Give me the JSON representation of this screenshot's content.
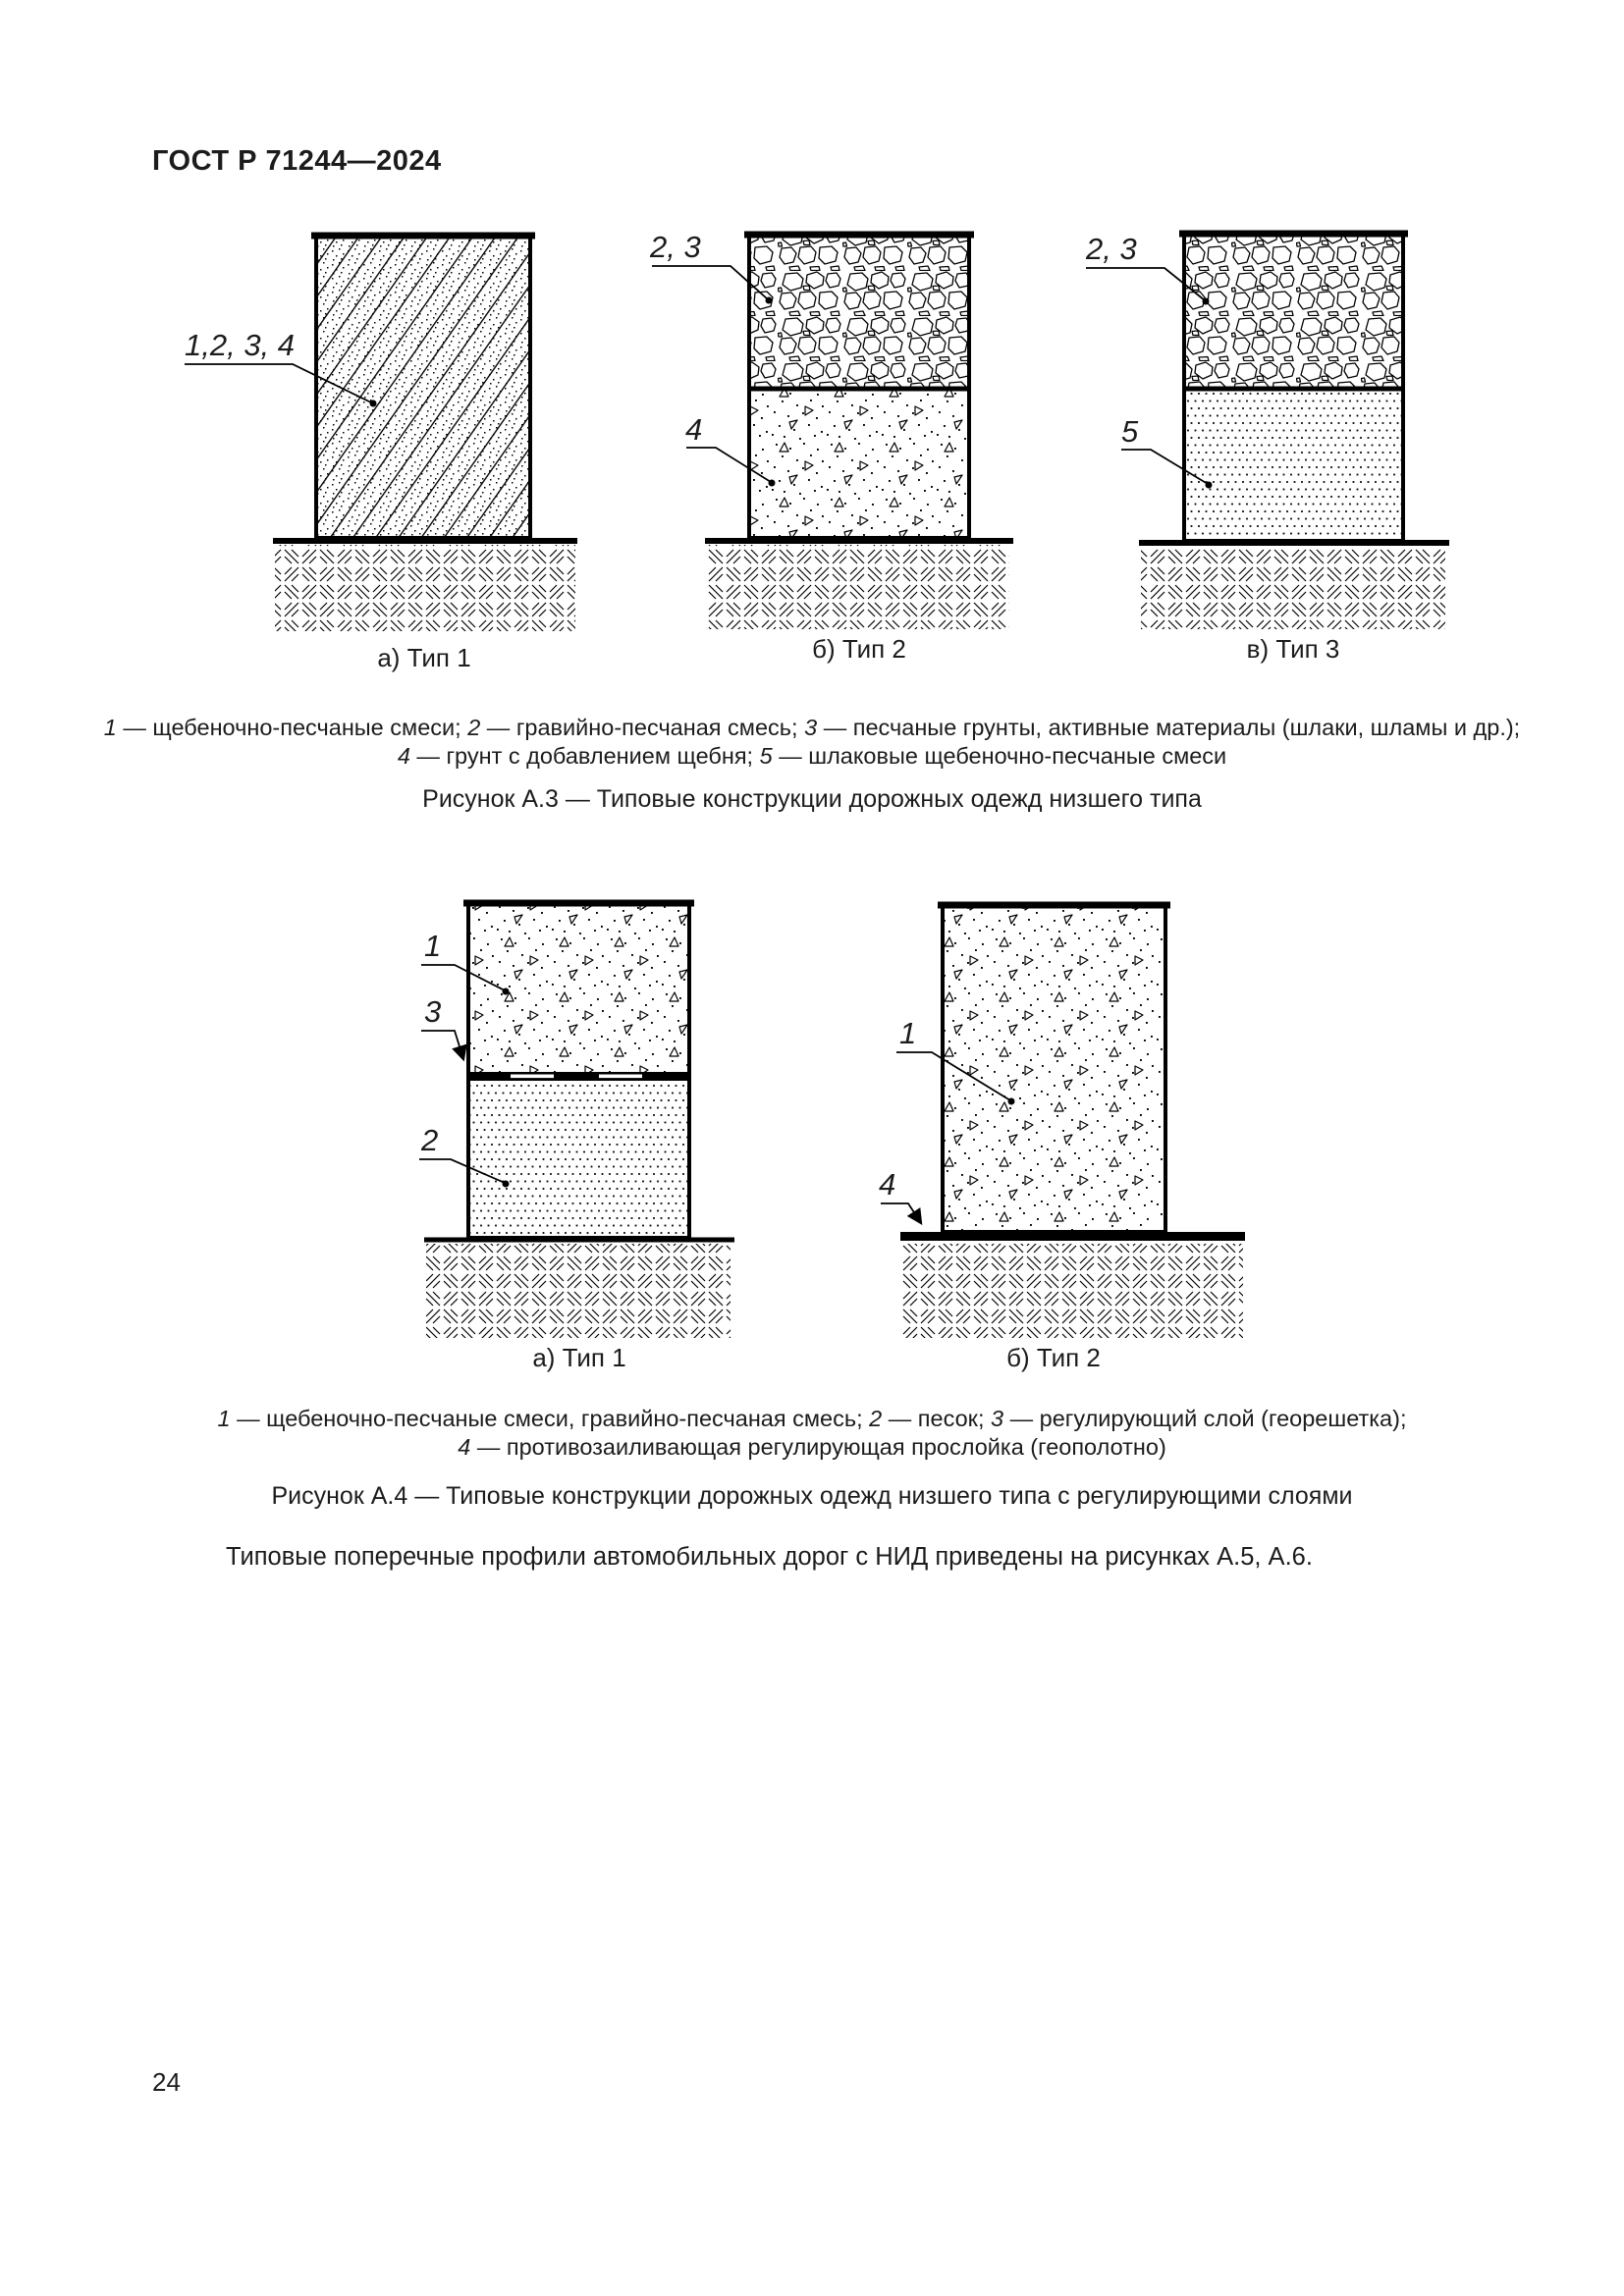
{
  "colors": {
    "ink": "#000000",
    "paper": "#ffffff"
  },
  "page": {
    "header": "ГОСТ Р 71244—2024",
    "number": "24"
  },
  "figure_a3": {
    "diagrams": [
      {
        "label": "1,2, 3, 4",
        "caption": "а) Тип 1"
      },
      {
        "label_top": "2, 3",
        "label_bottom": "4",
        "caption": "б) Тип 2"
      },
      {
        "label_top": "2, 3",
        "label_bottom": "5",
        "caption": "в) Тип 3"
      }
    ],
    "legend": {
      "line1": [
        {
          "num": "1",
          "text": " — щебеночно-песчаные смеси; "
        },
        {
          "num": "2",
          "text": " — гравийно-песчаная смесь; "
        },
        {
          "num": "3",
          "text": " — песчаные грунты, активные материалы (шлаки, шламы и др.);"
        }
      ],
      "line2": [
        {
          "num": "4",
          "text": " — грунт с добавлением щебня; "
        },
        {
          "num": "5",
          "text": " — шлаковые щебеночно-песчаные смеси"
        }
      ]
    },
    "caption": "Рисунок А.3 — Типовые конструкции дорожных одежд низшего типа"
  },
  "figure_a4": {
    "diagrams": [
      {
        "label_top": "1",
        "label_mid": "3",
        "label_bottom": "2",
        "caption": "а) Тип 1"
      },
      {
        "label_top": "1",
        "label_bottom": "4",
        "caption": "б) Тип 2"
      }
    ],
    "legend": {
      "line1": [
        {
          "num": "1",
          "text": " — щебеночно-песчаные смеси, гравийно-песчаная смесь; "
        },
        {
          "num": "2",
          "text": " — песок; "
        },
        {
          "num": "3",
          "text": " — регулирующий слой (георешетка);"
        }
      ],
      "line2": [
        {
          "num": "4",
          "text": " — противозаиливающая регулирующая прослойка (геополотно)"
        }
      ]
    },
    "caption": "Рисунок А.4 — Типовые конструкции дорожных одежд низшего типа с регулирующими слоями"
  },
  "body_text": "Типовые поперечные профили автомобильных дорог с НИД приведены на рисунках А.5, А.6."
}
